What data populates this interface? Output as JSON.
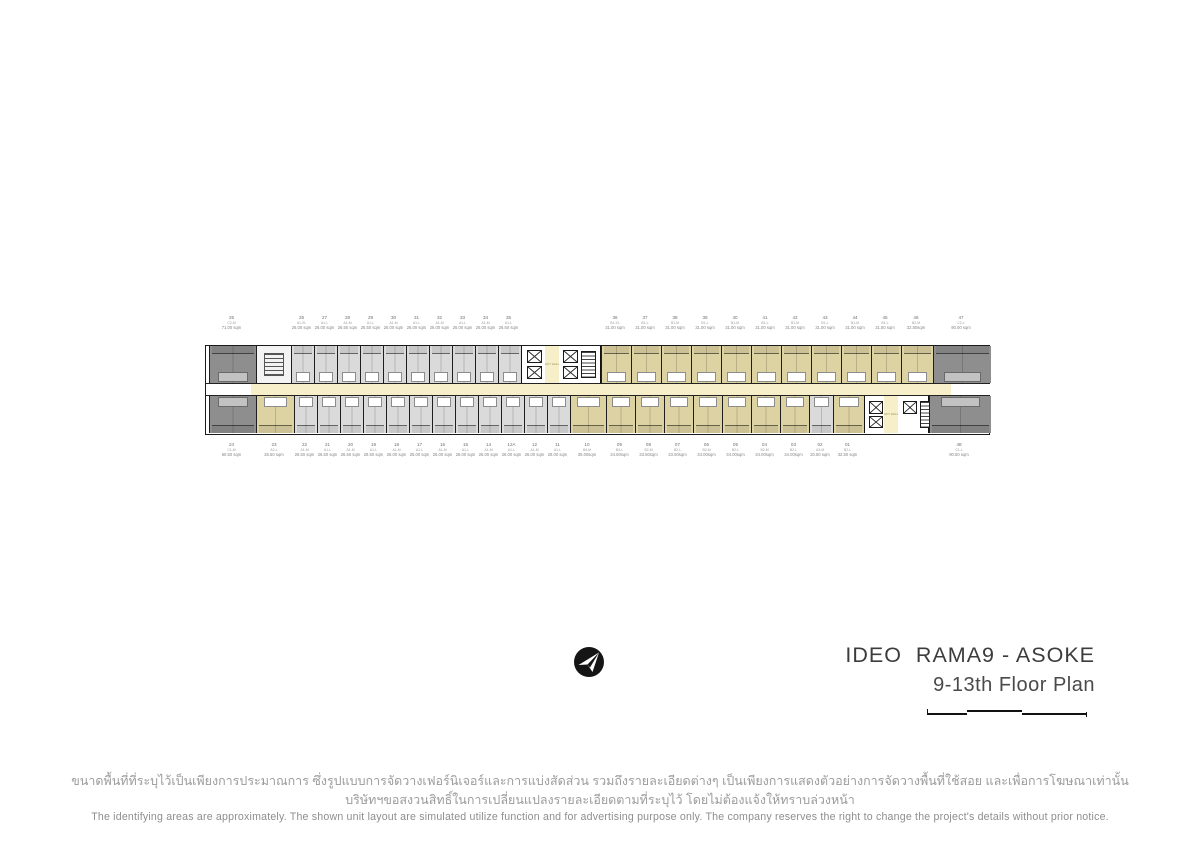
{
  "title_block": {
    "project": "IDEO  RAMA9 - ASOKE",
    "floor": "9-13th Floor Plan",
    "logo": "ananda-arrow-logo",
    "text_color": "#3c3c3c"
  },
  "disclaimer": {
    "thai_line1": "ขนาดพื้นที่ที่ระบุไว้เป็นเพียงการประมาณการ ซึ่งรูปแบบการจัดวางเฟอร์นิเจอร์และการแบ่งสัดส่วน รวมถึงรายละเอียดต่างๆ เป็นเพียงการแสดงตัวอย่างการจัดวางพื้นที่ใช้สอย และเพื่อการโฆษณาเท่านั้น",
    "thai_line2": "บริษัทฯขอสงวนสิทธิ์ในการเปลี่ยนแปลงรายละเอียดตามที่ระบุไว้ โดยไม่ต้องแจ้งให้ทราบล่วงหน้า",
    "english": "The identifying areas are approximately. The shown unit layout are simulated utilize function and for advertising purpose only. The company reserves the right to change the project's details without prior notice."
  },
  "floor_plan": {
    "colors": {
      "dark_unit": "#8e8e8e",
      "light_unit": "#dadada",
      "tan_unit": "#ddd2a2",
      "corridor": "#f6efca",
      "walls": "#1a1a1a",
      "label_text": "#858585"
    },
    "lift_hall_label": "LIFT\nHALL",
    "corridor_segments": [
      {
        "x": 0,
        "w": 45,
        "fill": "white"
      },
      {
        "x": 45,
        "w": 700,
        "fill": "cream"
      },
      {
        "x": 745,
        "w": 40,
        "fill": "white"
      }
    ],
    "top_cells": [
      {
        "kind": "unit",
        "no": "25",
        "type": "C2-M",
        "size": "71.00 sqm",
        "x": 3,
        "w": 47,
        "fill": "dark"
      },
      {
        "kind": "service",
        "x": 50,
        "w": 35
      },
      {
        "kind": "unit",
        "no": "26",
        "type": "A1-XL",
        "size": "26.00 sqm",
        "x": 85,
        "w": 23,
        "fill": "light"
      },
      {
        "kind": "unit",
        "no": "27",
        "type": "A1-L",
        "size": "26.00 sqm",
        "x": 108,
        "w": 23,
        "fill": "light"
      },
      {
        "kind": "unit",
        "no": "28",
        "type": "A1-M",
        "size": "26.50 sqm",
        "x": 131,
        "w": 23,
        "fill": "light"
      },
      {
        "kind": "unit",
        "no": "29",
        "type": "A1-L",
        "size": "26.50 sqm",
        "x": 154,
        "w": 23,
        "fill": "light"
      },
      {
        "kind": "unit",
        "no": "30",
        "type": "A1-M",
        "size": "26.00 sqm",
        "x": 177,
        "w": 23,
        "fill": "light"
      },
      {
        "kind": "unit",
        "no": "31",
        "type": "A1-L",
        "size": "26.00 sqm",
        "x": 200,
        "w": 23,
        "fill": "light"
      },
      {
        "kind": "unit",
        "no": "32",
        "type": "A1-M",
        "size": "26.00 sqm",
        "x": 223,
        "w": 23,
        "fill": "light"
      },
      {
        "kind": "unit",
        "no": "33",
        "type": "A1-L",
        "size": "26.00 sqm",
        "x": 246,
        "w": 23,
        "fill": "light"
      },
      {
        "kind": "unit",
        "no": "34",
        "type": "A1-M",
        "size": "26.00 sqm",
        "x": 269,
        "w": 23,
        "fill": "light"
      },
      {
        "kind": "unit",
        "no": "35",
        "type": "A1-L",
        "size": "26.50 sqm",
        "x": 292,
        "w": 23,
        "fill": "light"
      },
      {
        "kind": "core",
        "x": 315,
        "w": 80
      },
      {
        "kind": "unit",
        "no": "36",
        "type": "B1-XL",
        "size": "31.00 sqm",
        "x": 395,
        "w": 30,
        "fill": "tan"
      },
      {
        "kind": "unit",
        "no": "37",
        "type": "B1-L",
        "size": "31.00 sqm",
        "x": 425,
        "w": 30,
        "fill": "tan"
      },
      {
        "kind": "unit",
        "no": "38",
        "type": "B1-M",
        "size": "31.00 sqm",
        "x": 455,
        "w": 30,
        "fill": "tan"
      },
      {
        "kind": "unit",
        "no": "39",
        "type": "B1-L",
        "size": "31.00 sqm",
        "x": 485,
        "w": 30,
        "fill": "tan"
      },
      {
        "kind": "unit",
        "no": "40",
        "type": "B1-M",
        "size": "31.00 sqm",
        "x": 515,
        "w": 30,
        "fill": "tan"
      },
      {
        "kind": "unit",
        "no": "41",
        "type": "B1-L",
        "size": "31.00 sqm",
        "x": 545,
        "w": 30,
        "fill": "tan"
      },
      {
        "kind": "unit",
        "no": "42",
        "type": "B1-M",
        "size": "31.00 sqm",
        "x": 575,
        "w": 30,
        "fill": "tan"
      },
      {
        "kind": "unit",
        "no": "43",
        "type": "B1-L",
        "size": "31.00 sqm",
        "x": 605,
        "w": 30,
        "fill": "tan"
      },
      {
        "kind": "unit",
        "no": "44",
        "type": "B1-M",
        "size": "31.00 sqm",
        "x": 635,
        "w": 30,
        "fill": "tan"
      },
      {
        "kind": "unit",
        "no": "45",
        "type": "B1-L",
        "size": "31.50 sqm",
        "x": 665,
        "w": 30,
        "fill": "tan"
      },
      {
        "kind": "unit",
        "no": "46",
        "type": "B2-M",
        "size": "32.50sqm",
        "x": 695,
        "w": 32,
        "fill": "tan"
      },
      {
        "kind": "unit",
        "no": "47",
        "type": "C2-L",
        "size": "90.00 sqm",
        "x": 727,
        "w": 58,
        "fill": "dark"
      }
    ],
    "bottom_cells": [
      {
        "kind": "unit",
        "no": "24",
        "type": "C1-M",
        "size": "60.50 sqm",
        "x": 3,
        "w": 47,
        "fill": "dark"
      },
      {
        "kind": "unit",
        "no": "23",
        "type": "A2-L",
        "size": "26.50 sqm",
        "x": 50,
        "w": 38,
        "fill": "tan"
      },
      {
        "kind": "unit",
        "no": "22",
        "type": "A1-M",
        "size": "26.50 sqm",
        "x": 88,
        "w": 23,
        "fill": "light"
      },
      {
        "kind": "unit",
        "no": "21",
        "type": "A1-L",
        "size": "26.50 sqm",
        "x": 111,
        "w": 23,
        "fill": "light"
      },
      {
        "kind": "unit",
        "no": "20",
        "type": "A1-M",
        "size": "26.50 sqm",
        "x": 134,
        "w": 23,
        "fill": "light"
      },
      {
        "kind": "unit",
        "no": "19",
        "type": "A1-L",
        "size": "26.50 sqm",
        "x": 157,
        "w": 23,
        "fill": "light"
      },
      {
        "kind": "unit",
        "no": "18",
        "type": "A1-M",
        "size": "26.00 sqm",
        "x": 180,
        "w": 23,
        "fill": "light"
      },
      {
        "kind": "unit",
        "no": "17",
        "type": "A1-L",
        "size": "26.00 sqm",
        "x": 203,
        "w": 23,
        "fill": "light"
      },
      {
        "kind": "unit",
        "no": "16",
        "type": "A1-M",
        "size": "26.00 sqm",
        "x": 226,
        "w": 23,
        "fill": "light"
      },
      {
        "kind": "unit",
        "no": "15",
        "type": "A1-L",
        "size": "26.00 sqm",
        "x": 249,
        "w": 23,
        "fill": "light"
      },
      {
        "kind": "unit",
        "no": "14",
        "type": "A1-M",
        "size": "26.00 sqm",
        "x": 272,
        "w": 23,
        "fill": "light"
      },
      {
        "kind": "unit",
        "no": "12A",
        "type": "A1-L",
        "size": "26.00 sqm",
        "x": 295,
        "w": 23,
        "fill": "light"
      },
      {
        "kind": "unit",
        "no": "12",
        "type": "A1-M",
        "size": "26.00 sqm",
        "x": 318,
        "w": 23,
        "fill": "light"
      },
      {
        "kind": "unit",
        "no": "11",
        "type": "A1-L",
        "size": "26.00 sqm",
        "x": 341,
        "w": 23,
        "fill": "light"
      },
      {
        "kind": "unit",
        "no": "10",
        "type": "B4-M",
        "size": "36.00sqm",
        "x": 364,
        "w": 36,
        "fill": "tan"
      },
      {
        "kind": "unit",
        "no": "09",
        "type": "B3-L",
        "size": "34.50sqm",
        "x": 400,
        "w": 29,
        "fill": "tan"
      },
      {
        "kind": "unit",
        "no": "08",
        "type": "B2-M",
        "size": "33.50sqm",
        "x": 429,
        "w": 29,
        "fill": "tan"
      },
      {
        "kind": "unit",
        "no": "07",
        "type": "B2-L",
        "size": "33.50sqm",
        "x": 458,
        "w": 29,
        "fill": "tan"
      },
      {
        "kind": "unit",
        "no": "06",
        "type": "B2-M",
        "size": "34.00sqm",
        "x": 487,
        "w": 29,
        "fill": "tan"
      },
      {
        "kind": "unit",
        "no": "05",
        "type": "B2-L",
        "size": "34.00sqm",
        "x": 516,
        "w": 29,
        "fill": "tan"
      },
      {
        "kind": "unit",
        "no": "04",
        "type": "B2-M",
        "size": "34.00sqm",
        "x": 545,
        "w": 29,
        "fill": "tan"
      },
      {
        "kind": "unit",
        "no": "03",
        "type": "B2-L",
        "size": "34.00sqm",
        "x": 574,
        "w": 29,
        "fill": "tan"
      },
      {
        "kind": "unit",
        "no": "02",
        "type": "A3-M",
        "size": "20.50 sqm",
        "x": 603,
        "w": 24,
        "fill": "light"
      },
      {
        "kind": "unit",
        "no": "01",
        "type": "B2-L",
        "size": "32.50 sqm",
        "x": 627,
        "w": 31,
        "fill": "tan"
      },
      {
        "kind": "core",
        "x": 658,
        "w": 65
      },
      {
        "kind": "unit",
        "no": "48",
        "type": "C1-L",
        "size": "90.50 sqm",
        "x": 723,
        "w": 62,
        "fill": "dark"
      }
    ]
  }
}
